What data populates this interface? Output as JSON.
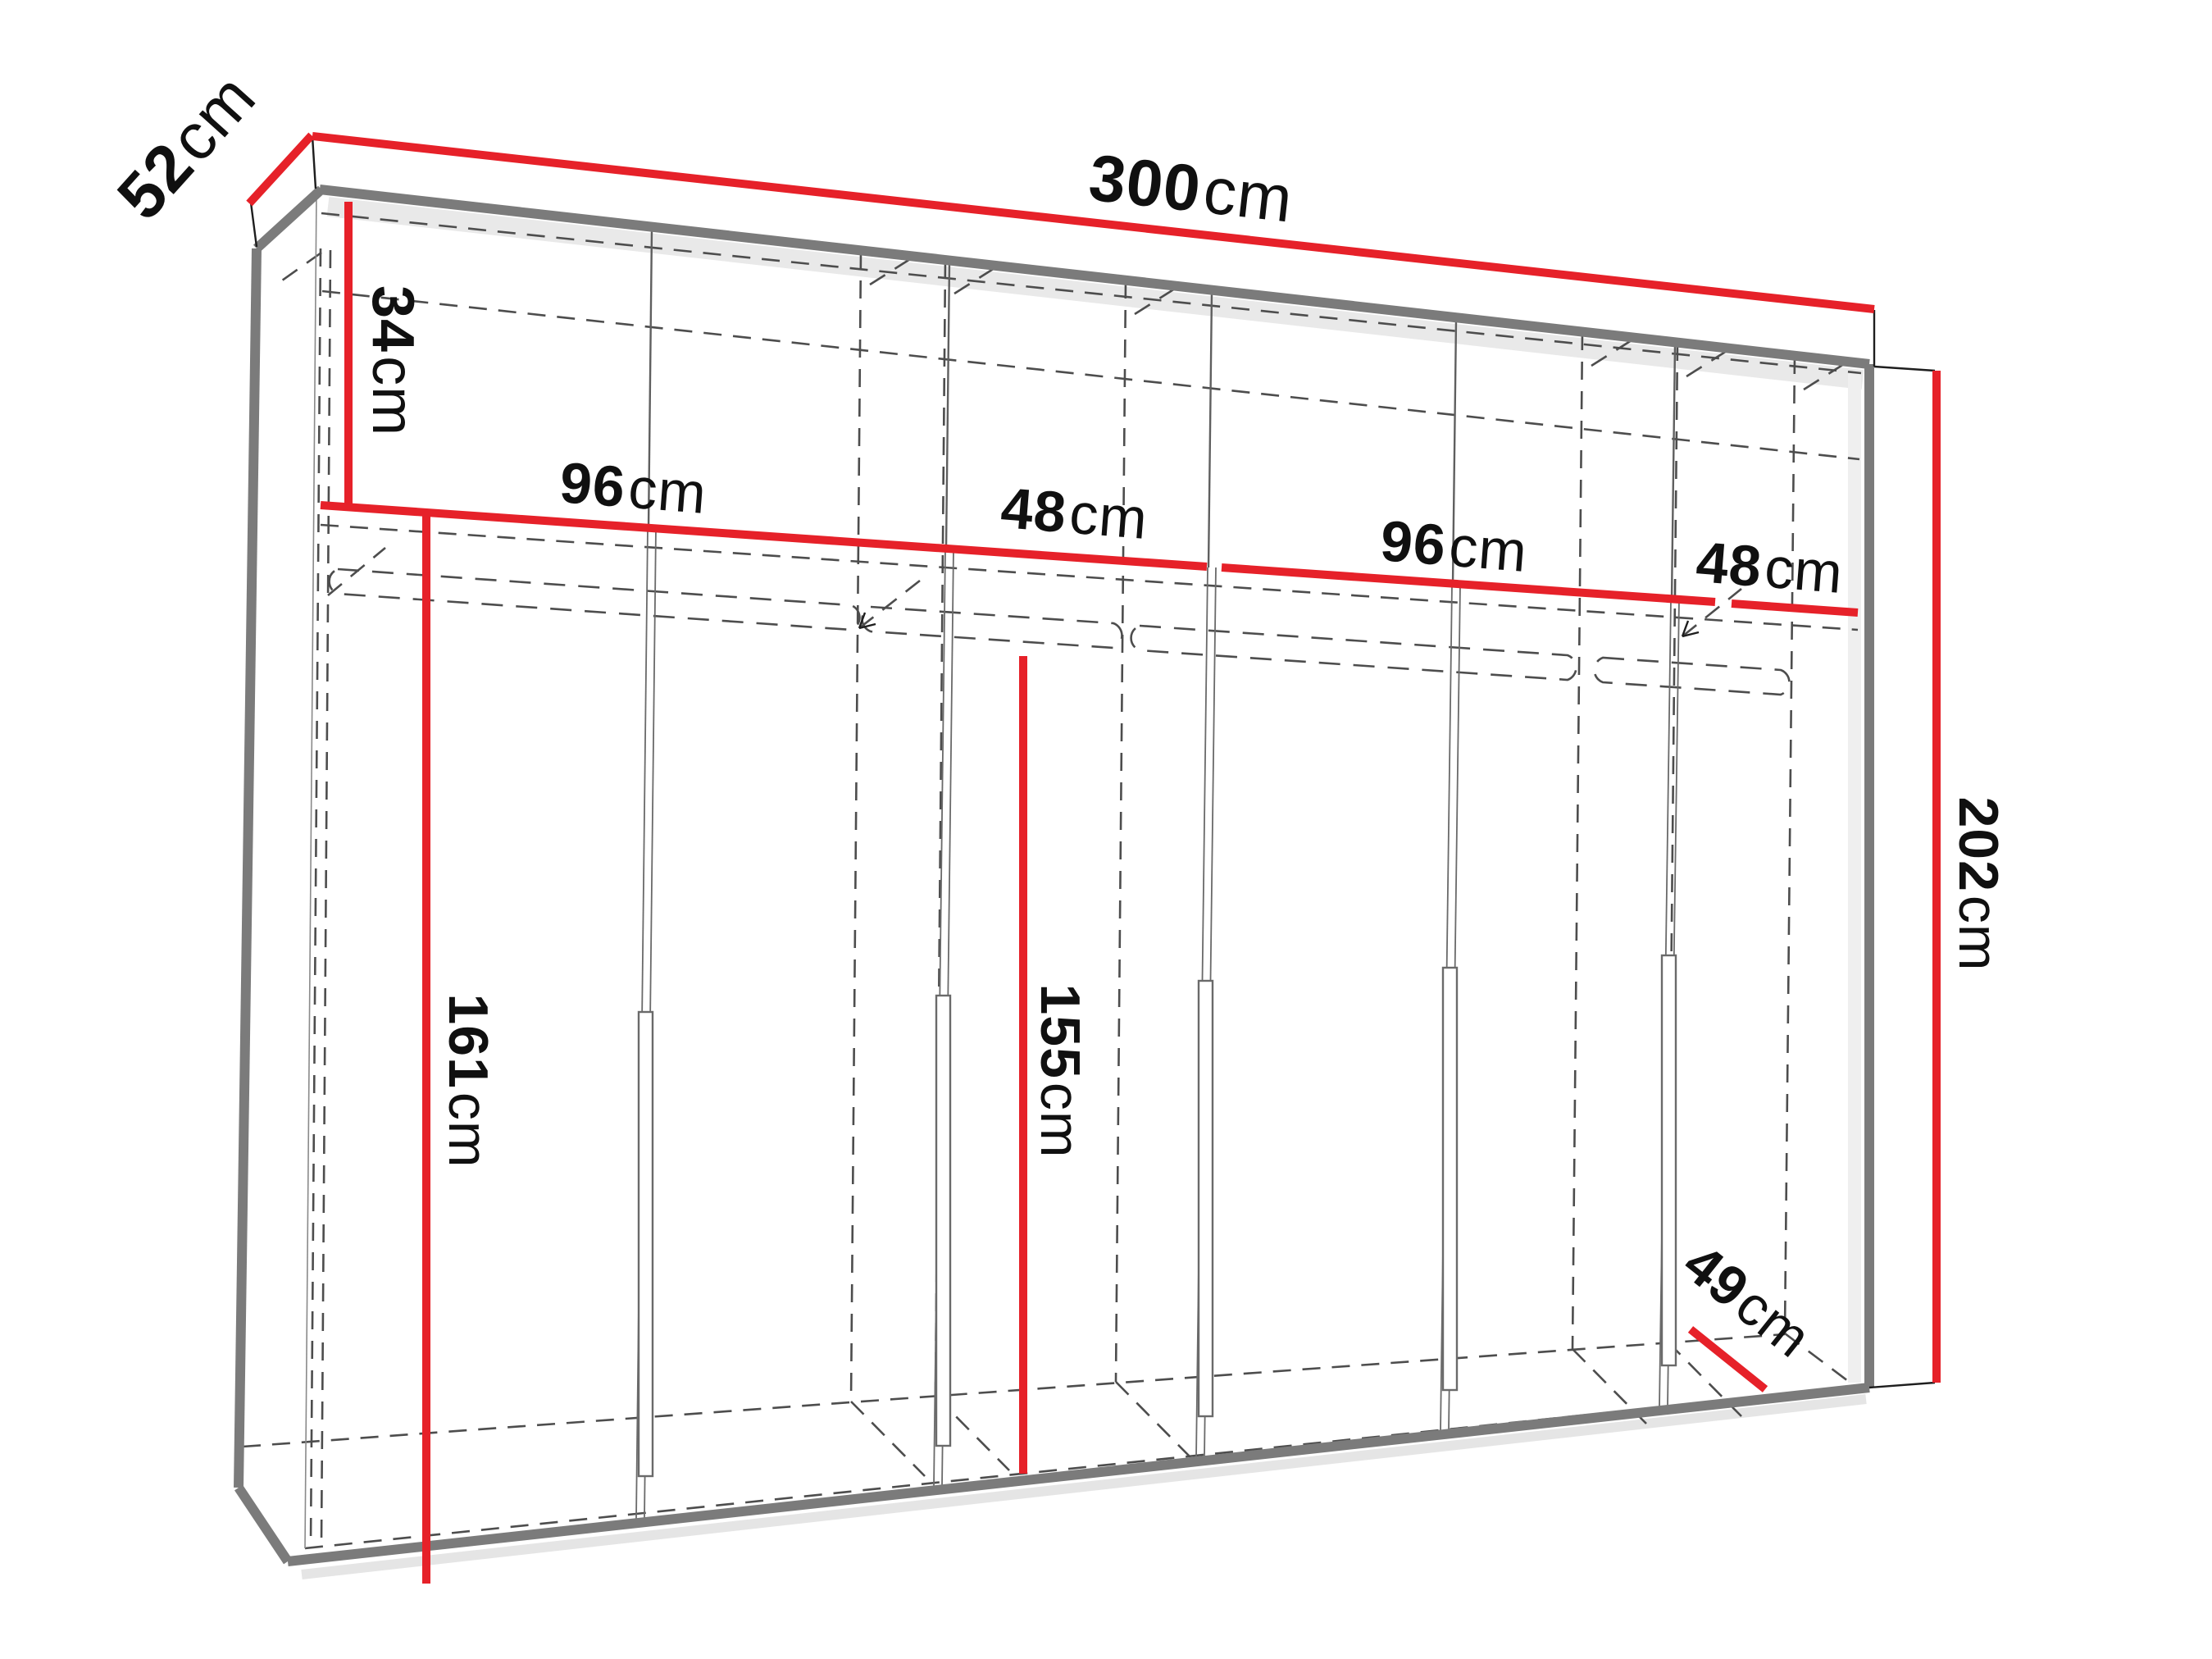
{
  "diagram": {
    "kind": "furniture-dimension-diagram",
    "subject": "six-door wardrobe, perspective line drawing",
    "unit": "cm",
    "colors": {
      "dimension_line": "#e62129",
      "structure_edge": "#7b7b7b",
      "hidden_line": "#4d4d4d",
      "label_text": "#101010",
      "background": "#ffffff"
    },
    "dimensions": {
      "depth_top": {
        "value": "52",
        "unit": "cm"
      },
      "total_width": {
        "value": "300",
        "unit": "cm"
      },
      "top_section_height": {
        "value": "34",
        "unit": "cm"
      },
      "bay1_width": {
        "value": "96",
        "unit": "cm"
      },
      "bay2_width": {
        "value": "48",
        "unit": "cm"
      },
      "bay3_width": {
        "value": "96",
        "unit": "cm"
      },
      "bay4_width": {
        "value": "48",
        "unit": "cm"
      },
      "left_interior_height": {
        "value": "161",
        "unit": "cm"
      },
      "middle_interior_height": {
        "value": "155",
        "unit": "cm"
      },
      "total_height": {
        "value": "202",
        "unit": "cm"
      },
      "bottom_depth": {
        "value": "49",
        "unit": "cm"
      }
    }
  }
}
